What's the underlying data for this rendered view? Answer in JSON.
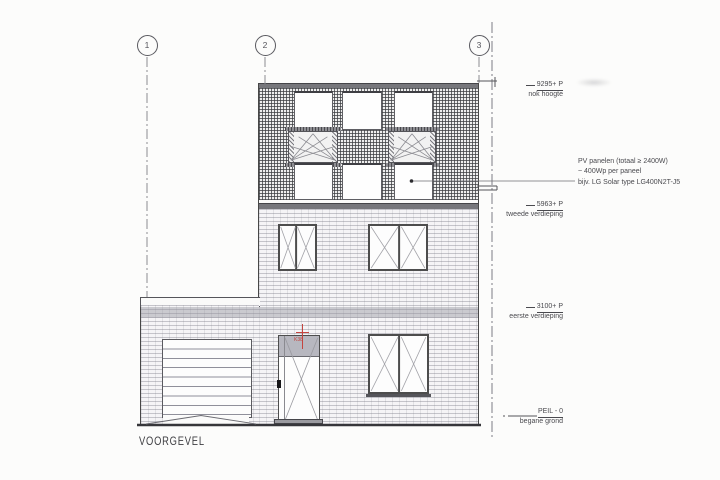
{
  "title": {
    "label": "VOORGEVEL"
  },
  "grid_markers": [
    {
      "number": "1"
    },
    {
      "number": "2"
    },
    {
      "number": "3"
    }
  ],
  "levels": [
    {
      "value": "9295+ P",
      "name": "nok hoogte"
    },
    {
      "value": "5963+ P",
      "name": "tweede verdieping"
    },
    {
      "value": "3100+ P",
      "name": "eerste verdieping"
    },
    {
      "value": "PEIL - 0",
      "name": "begane grond"
    }
  ],
  "pv_note": {
    "line1": "PV panelen (totaal ≥ 2400W)",
    "line2": "~ 400Wp per paneel",
    "line3": "bijv. LG Solar type LG400N2T-J5"
  },
  "door_tag": {
    "label": "K38"
  },
  "colors": {
    "line_grey": "#4a4a4f",
    "red_annotation": "#c4453f",
    "band_grey": "#77777c"
  }
}
